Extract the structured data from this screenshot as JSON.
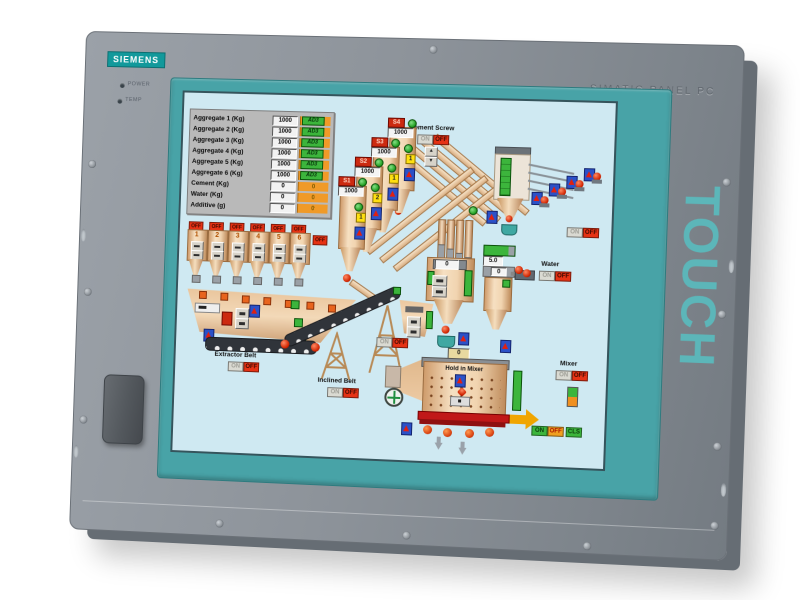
{
  "device": {
    "brand": "SIEMENS",
    "model": "SIMATIC PANEL PC",
    "touch": "TOUCH",
    "led_power": "POWER",
    "led_temp": "TEMP"
  },
  "common": {
    "on": "ON",
    "off": "OFF"
  },
  "hmi": {
    "batch_table": {
      "rows": [
        {
          "label": "Aggregate 1 (Kg)",
          "value": "1000",
          "status": "AD3"
        },
        {
          "label": "Aggregate 2 (Kg)",
          "value": "1000",
          "status": "AD3"
        },
        {
          "label": "Aggregate 3 (Kg)",
          "value": "1000",
          "status": "AD3"
        },
        {
          "label": "Aggregate 4 (Kg)",
          "value": "1000",
          "status": "AD3"
        },
        {
          "label": "Aggregate 5 (Kg)",
          "value": "1000",
          "status": "AD3"
        },
        {
          "label": "Aggregate 6 (Kg)",
          "value": "1000",
          "status": "AD3"
        },
        {
          "label": "Cement (Kg)",
          "value": "0",
          "status": "0"
        },
        {
          "label": "Water (Kg)",
          "value": "0",
          "status": "0"
        },
        {
          "label": "Additive (g)",
          "value": "0",
          "status": "0"
        }
      ]
    },
    "silos": [
      {
        "tag": "S1",
        "value": "1000",
        "num": "1"
      },
      {
        "tag": "S2",
        "value": "1000",
        "num": "2"
      },
      {
        "tag": "S3",
        "value": "1000",
        "num": "1"
      },
      {
        "tag": "S4",
        "value": "1000",
        "num": "1"
      }
    ],
    "bins": [
      "1",
      "2",
      "3",
      "4",
      "5",
      "6"
    ],
    "cement_screw": {
      "label": "Cement Screw",
      "up": "▲",
      "down": "▼"
    },
    "cement_hopper": {
      "value": "0"
    },
    "extractor": {
      "label": "Extractor Belt"
    },
    "inclined": {
      "label": "Inclined Belt"
    },
    "water": {
      "label": "Water",
      "setpoint": "5.0",
      "value": "0"
    },
    "additive": {
      "label": "Additive"
    },
    "mixer": {
      "hold_label": "Hold in Mixer",
      "hold_value": "0",
      "label": "Mixer",
      "btn_on": "ON",
      "btn_off": "OFF",
      "btn_cls": "CLS"
    }
  }
}
